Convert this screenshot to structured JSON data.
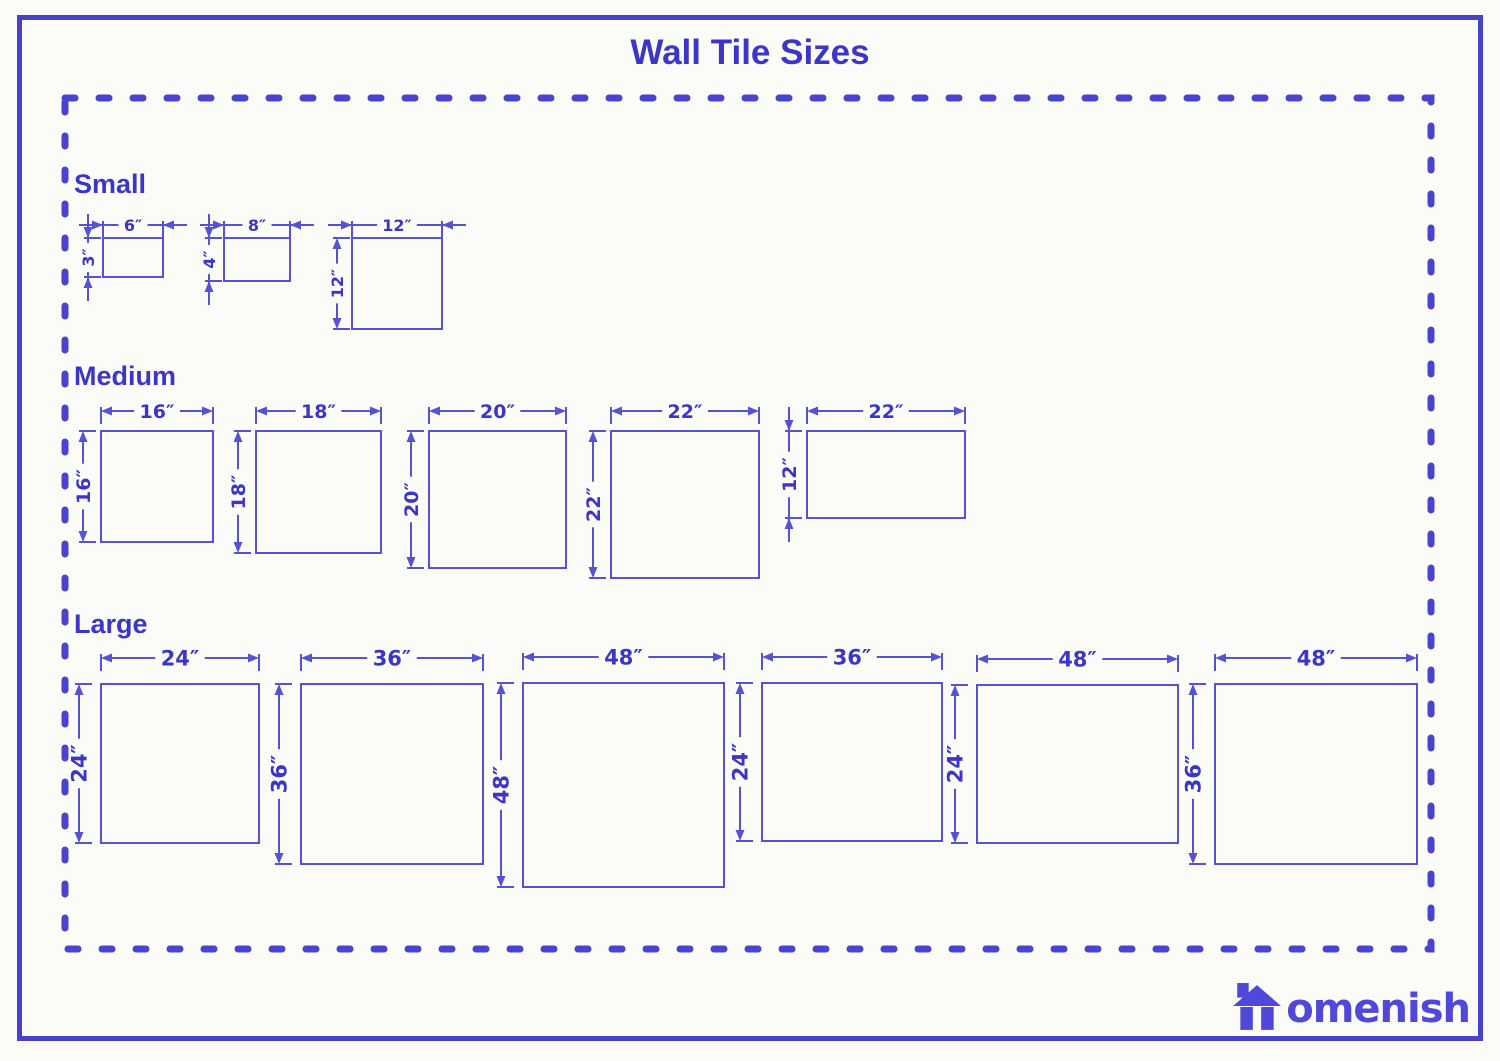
{
  "page": {
    "title": "Wall Tile Sizes",
    "width": 1500,
    "height": 1061,
    "colors": {
      "background": "#fbfbf7",
      "ink": "#3b35c8",
      "line": "#5652d4",
      "border": "#4642cb",
      "dashed_border": "#4844cf",
      "logo": "#4f48d9"
    }
  },
  "logo": {
    "brand": "Homenish",
    "icon": "house-icon",
    "text_after_icon": "omenish"
  },
  "diagram": {
    "dashed_frame": {
      "x": 65,
      "y": 98,
      "w": 1366,
      "h": 851
    },
    "sections": [
      {
        "id": "small",
        "label": "Small",
        "label_top": 170,
        "dim_font": 16,
        "top_offset": 13,
        "left_offset": 15,
        "tiles": [
          {
            "name": "6x3",
            "width_in": 6,
            "height_in": 3,
            "width_label": "6″",
            "height_label": "3″",
            "rect": [
              103,
              238,
              60,
              39
            ],
            "h_mode": "outside",
            "v_mode": "outside"
          },
          {
            "name": "8x4",
            "width_in": 8,
            "height_in": 4,
            "width_label": "8″",
            "height_label": "4″",
            "rect": [
              224,
              238,
              66,
              43
            ],
            "h_mode": "outside",
            "v_mode": "outside"
          },
          {
            "name": "12x12",
            "width_in": 12,
            "height_in": 12,
            "width_label": "12″",
            "height_label": "12″",
            "rect": [
              352,
              238,
              90,
              91
            ],
            "h_mode": "outside",
            "v_mode": "inside"
          }
        ]
      },
      {
        "id": "medium",
        "label": "Medium",
        "label_top": 362,
        "dim_font": 19,
        "top_offset": 20,
        "left_offset": 18,
        "tiles": [
          {
            "name": "16x16",
            "width_in": 16,
            "height_in": 16,
            "width_label": "16″",
            "height_label": "16″",
            "rect": [
              101,
              431,
              112,
              111
            ],
            "h_mode": "inside",
            "v_mode": "inside"
          },
          {
            "name": "18x18",
            "width_in": 18,
            "height_in": 18,
            "width_label": "18″",
            "height_label": "18″",
            "rect": [
              256,
              431,
              125,
              122
            ],
            "h_mode": "inside",
            "v_mode": "inside"
          },
          {
            "name": "20x20",
            "width_in": 20,
            "height_in": 20,
            "width_label": "20″",
            "height_label": "20″",
            "rect": [
              429,
              431,
              137,
              137
            ],
            "h_mode": "inside",
            "v_mode": "inside"
          },
          {
            "name": "22x22",
            "width_in": 22,
            "height_in": 22,
            "width_label": "22″",
            "height_label": "22″",
            "rect": [
              611,
              431,
              148,
              147
            ],
            "h_mode": "inside",
            "v_mode": "inside"
          },
          {
            "name": "22x12",
            "width_in": 22,
            "height_in": 12,
            "width_label": "22″",
            "height_label": "12″",
            "rect": [
              807,
              431,
              158,
              87
            ],
            "h_mode": "inside",
            "v_mode": "outside"
          }
        ]
      },
      {
        "id": "large",
        "label": "Large",
        "label_top": 610,
        "dim_font": 21,
        "top_offset": 26,
        "left_offset": 22,
        "tiles": [
          {
            "name": "24x24",
            "width_in": 24,
            "height_in": 24,
            "width_label": "24″",
            "height_label": "24″",
            "rect": [
              101,
              684,
              158,
              159
            ],
            "h_mode": "inside",
            "v_mode": "inside"
          },
          {
            "name": "36x36",
            "width_in": 36,
            "height_in": 36,
            "width_label": "36″",
            "height_label": "36″",
            "rect": [
              301,
              684,
              182,
              180
            ],
            "h_mode": "inside",
            "v_mode": "inside"
          },
          {
            "name": "48x48",
            "width_in": 48,
            "height_in": 48,
            "width_label": "48″",
            "height_label": "48″",
            "rect": [
              523,
              683,
              201,
              204
            ],
            "h_mode": "inside",
            "v_mode": "inside"
          },
          {
            "name": "36x24",
            "width_in": 36,
            "height_in": 24,
            "width_label": "36″",
            "height_label": "24″",
            "rect": [
              762,
              683,
              180,
              158
            ],
            "h_mode": "inside",
            "v_mode": "inside"
          },
          {
            "name": "48x24",
            "width_in": 48,
            "height_in": 24,
            "width_label": "48″",
            "height_label": "24″",
            "rect": [
              977,
              685,
              201,
              158
            ],
            "h_mode": "inside",
            "v_mode": "inside"
          },
          {
            "name": "48x36",
            "width_in": 48,
            "height_in": 36,
            "width_label": "48″",
            "height_label": "36″",
            "rect": [
              1215,
              684,
              202,
              180
            ],
            "h_mode": "inside",
            "v_mode": "inside"
          }
        ]
      }
    ]
  }
}
